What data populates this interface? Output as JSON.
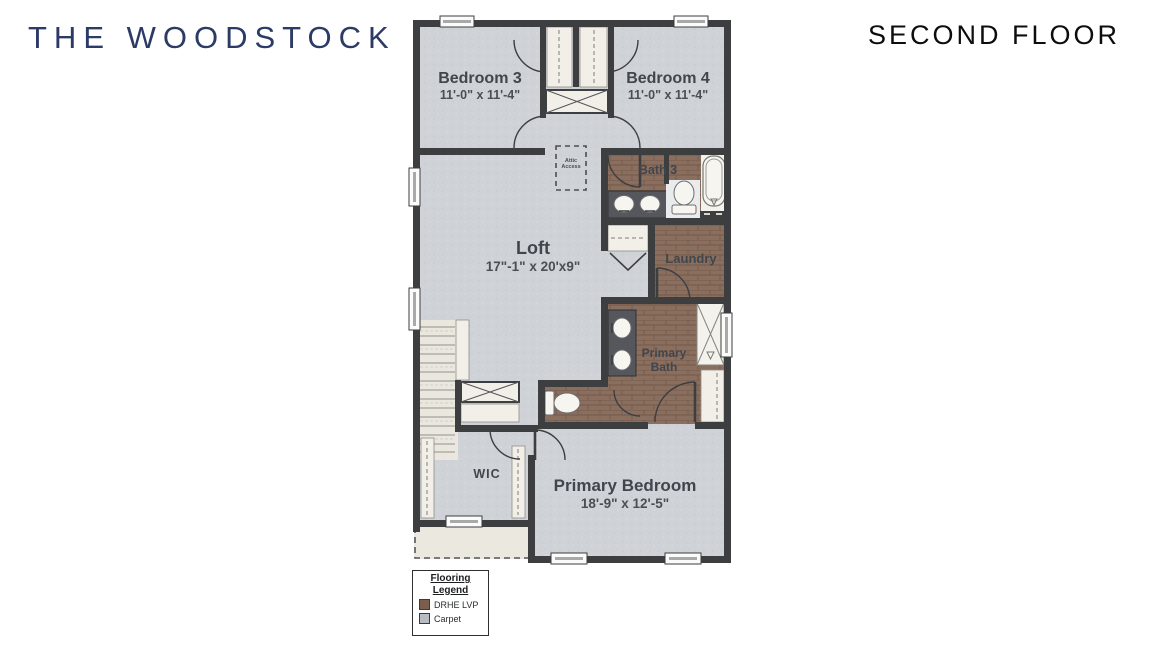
{
  "header": {
    "plan_name": "THE WOODSTOCK",
    "floor_label": "SECOND FLOOR"
  },
  "rooms": {
    "bedroom3": {
      "name": "Bedroom 3",
      "dims": "11'-0\" x 11'-4\""
    },
    "bedroom4": {
      "name": "Bedroom 4",
      "dims": "11'-0\" x 11'-4\""
    },
    "bath3": {
      "name": "Bath 3"
    },
    "loft": {
      "name": "Loft",
      "dims": "17\"-1\" x 20'x9\""
    },
    "laundry": {
      "name": "Laundry"
    },
    "primary_bath": {
      "name": "Primary Bath"
    },
    "wic": {
      "name": "WIC"
    },
    "primary_bedroom": {
      "name": "Primary Bedroom",
      "dims": "18'-9\" x 12'-5\""
    },
    "attic": {
      "name": "Attic Access"
    }
  },
  "legend": {
    "title": "Flooring Legend",
    "items": [
      {
        "label": "DRHE LVP",
        "color": "#7b5d4b"
      },
      {
        "label": "Carpet",
        "color": "#b7bbc2"
      }
    ]
  },
  "colors": {
    "wall": "#3d3e40",
    "carpet": "#cfd3d8",
    "lvp_wood": "#8a6f5f",
    "title_navy": "#2c3a66",
    "floor_title_black": "#0d0d0d"
  }
}
